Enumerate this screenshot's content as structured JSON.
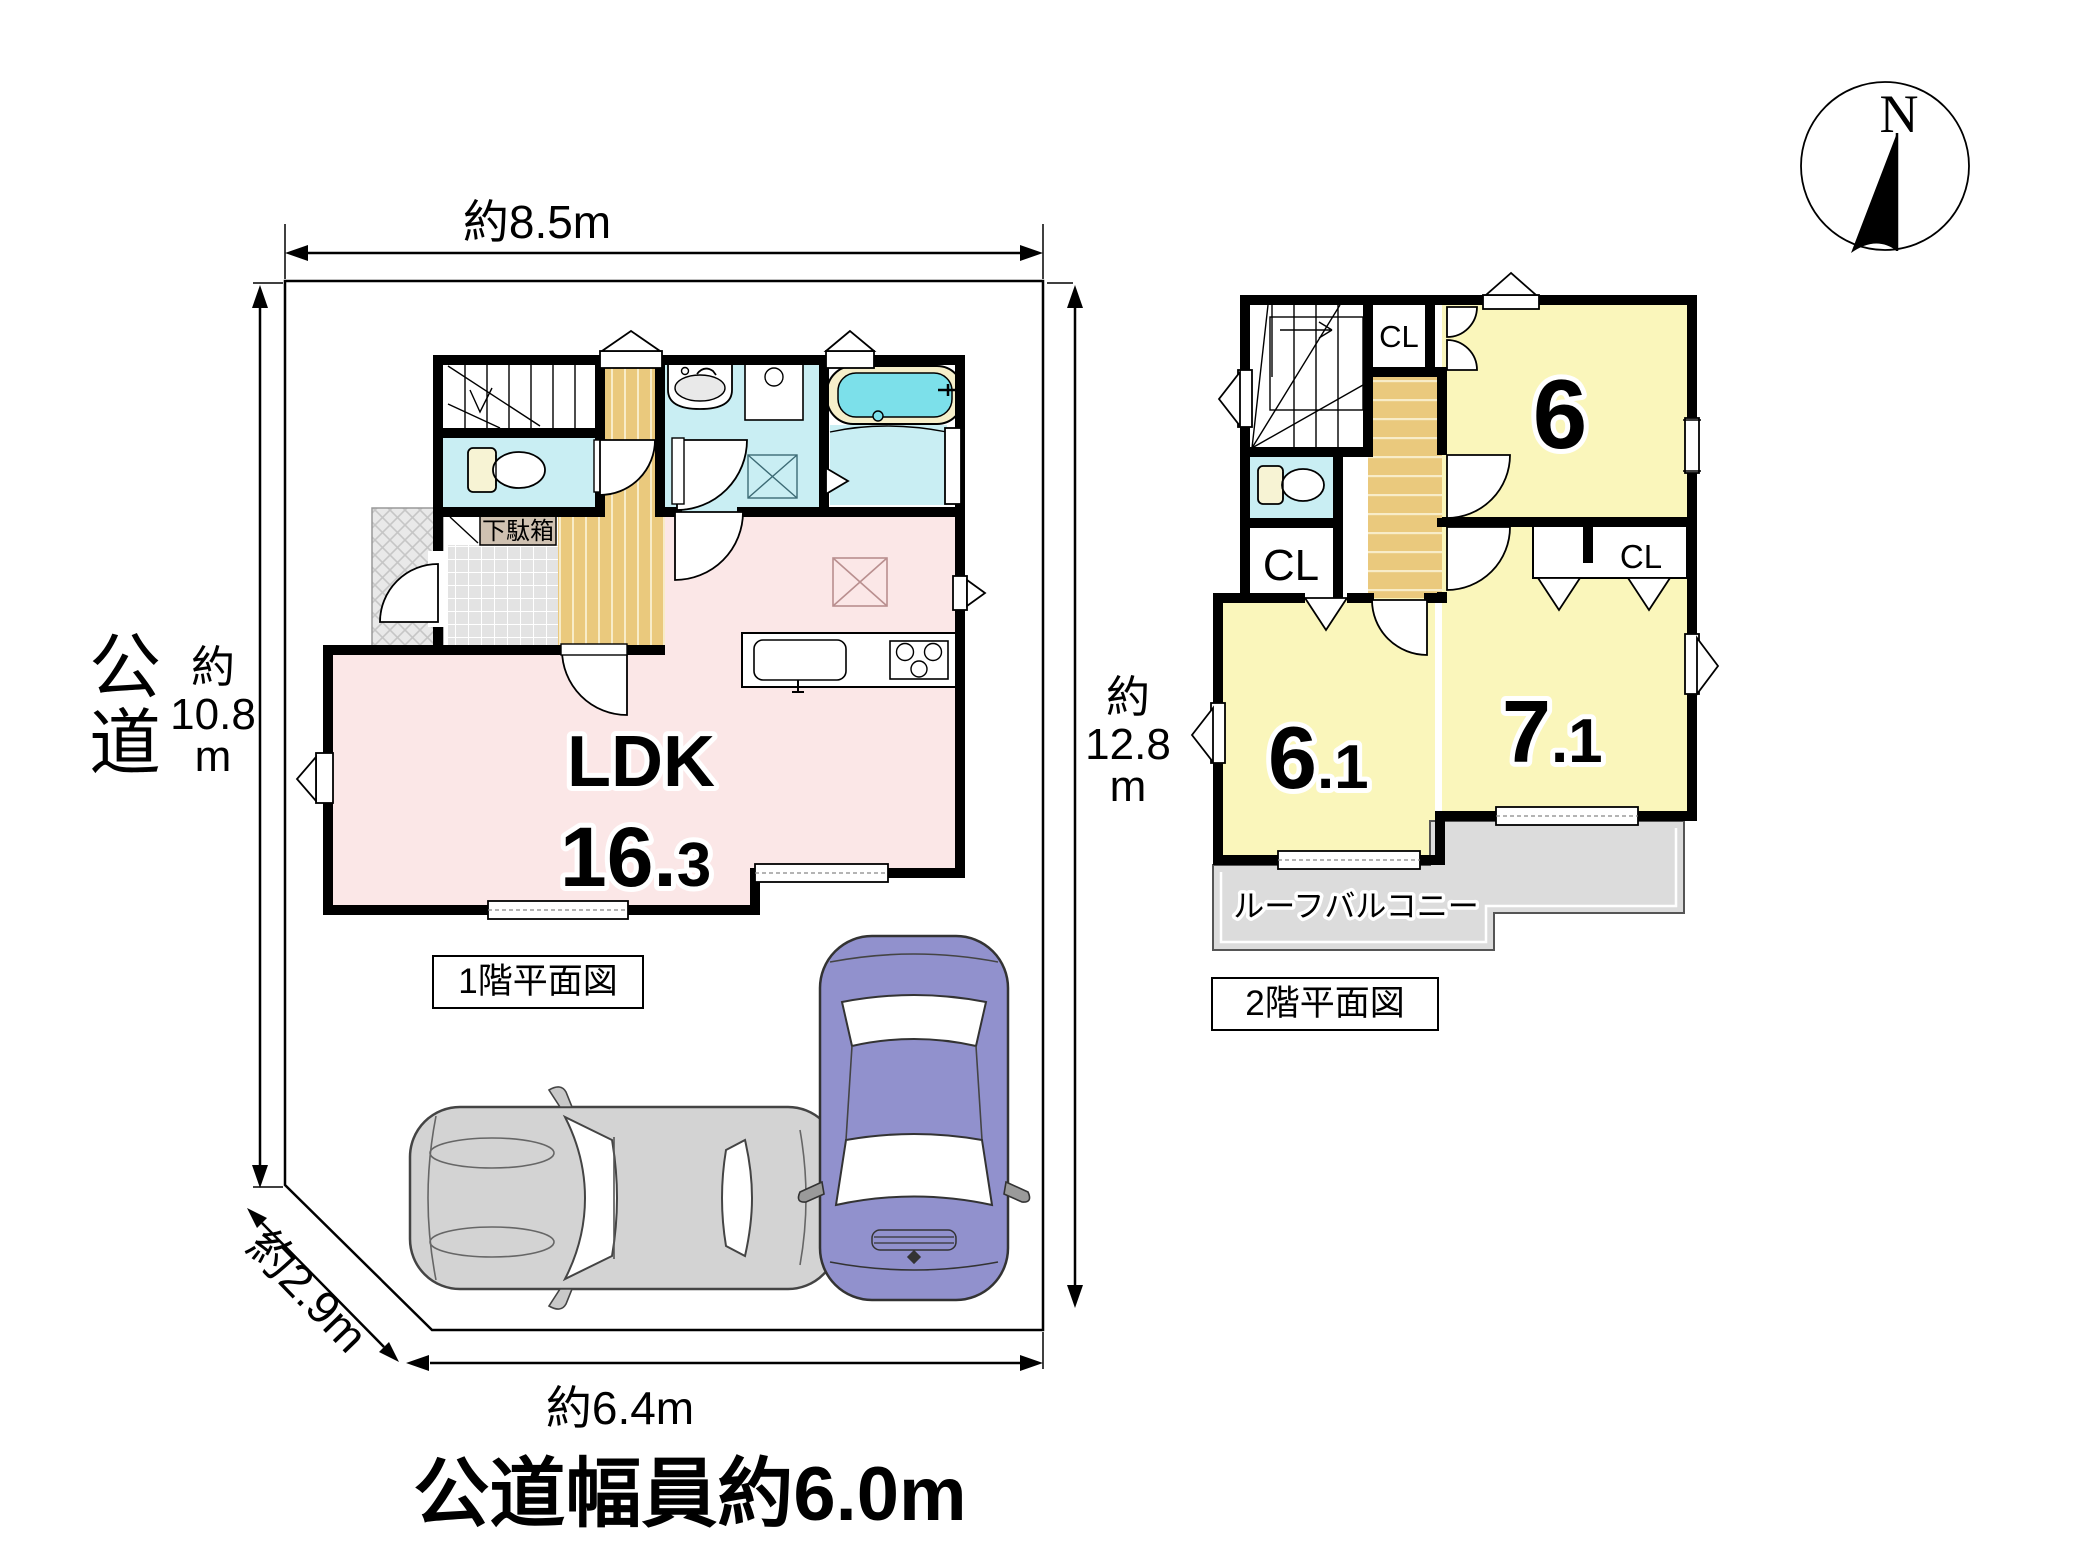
{
  "palette": {
    "wall": "#000000",
    "wet_room_cyan": "#c9eef3",
    "tub_water": "#7ce0ea",
    "ldk_pink": "#fbe7e7",
    "room_yellow": "#faf6bb",
    "wood_tan": "#eac97d",
    "balcony_gray": "#dcdcdc",
    "entry_tile": "#e3e3e3",
    "car_gray": "#d3d3d3",
    "car_purple": "#9191cd"
  },
  "compass": {
    "north_label": "N"
  },
  "site": {
    "road_label_1": "公",
    "road_label_2": "道",
    "road_width_label": "公道幅員約6.0m",
    "dim_top": "約8.5m",
    "dim_bottom": "約6.4m",
    "dim_corner": "約2.9m",
    "dim_left": [
      "約",
      "10.8",
      "m"
    ],
    "dim_right": [
      "約",
      "12.8",
      "m"
    ]
  },
  "floor1": {
    "caption": "1階平面図",
    "ldk_label": "LDK",
    "ldk_area_main": "16.",
    "ldk_area_sub": "3",
    "shoe_cabinet": "下駄箱"
  },
  "floor2": {
    "caption": "2階平面図",
    "room6": "6",
    "room61_main": "6",
    "room61_sub": ".1",
    "room71_main": "7",
    "room71_sub": ".1",
    "cl_top": "CL",
    "cl_left": "CL",
    "cl_right": "CL",
    "balcony": "ルーフバルコニー"
  }
}
